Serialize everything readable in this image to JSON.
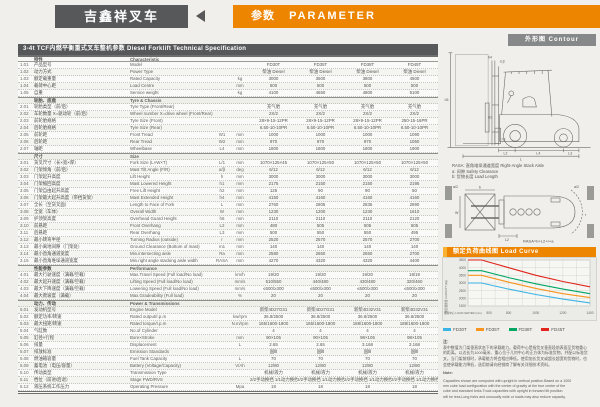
{
  "header": {
    "brand": "吉鑫祥叉车",
    "title_cn": "参数",
    "title_en": "PARAMETER"
  },
  "table": {
    "title": "3-4t TCF内燃平衡重式叉车整机参数  Diesel Forklift Technical Specification",
    "rows": [
      {
        "header": true,
        "cn": "特性",
        "en": "Characteristic"
      },
      {
        "no": "1.01",
        "cn": "产品型号",
        "en": "Model",
        "v": [
          "FD30T",
          "FD35T",
          "FD38T",
          "FD45T"
        ]
      },
      {
        "no": "1.02",
        "cn": "动力方式",
        "en": "Power Type",
        "v": [
          "柴油 Diesel",
          "柴油 Diesel",
          "柴油 Diesel",
          "柴油 Diesel"
        ]
      },
      {
        "no": "1.03",
        "cn": "额定载重量",
        "en": "Rated Capacity",
        "unit": "kg",
        "v": [
          "3000",
          "3500",
          "3800",
          "4500"
        ]
      },
      {
        "no": "1.04",
        "cn": "载荷中心距",
        "en": "Load Centre",
        "unit": "mm",
        "v": [
          "500",
          "500",
          "500",
          "500"
        ]
      },
      {
        "no": "1.05",
        "cn": "自重",
        "en": "Service weight",
        "unit": "kg",
        "v": [
          "4100",
          "4650",
          "4800",
          "5100"
        ]
      },
      {
        "section": true,
        "cn": "轮胎、底盘",
        "en": "Tyre & Chassis"
      },
      {
        "no": "2.01",
        "cn": "轮胎类型（前/后）",
        "en": "Tyre Type (Front/Rear)",
        "v": [
          "充气胎",
          "充气胎",
          "充气胎",
          "充气胎"
        ]
      },
      {
        "no": "2.02",
        "cn": "车轮数量 X=驱动轮（前/后）",
        "en": "Wheel number X=drive wheel (Front/Rear)",
        "v": [
          "2X/2",
          "2X/2",
          "2X/2",
          "2X/2"
        ]
      },
      {
        "no": "2.03",
        "cn": "前轮胎规格",
        "en": "Tyre Size (Front)",
        "v": [
          "28×9-15-12PR",
          "28×9-15-12PR",
          "28×9-15-12PR",
          "250-15-16PR"
        ]
      },
      {
        "no": "2.04",
        "cn": "后轮胎规格",
        "en": "Tyre Size (Rear)",
        "v": [
          "6.50-10-10PR",
          "6.50-10-10PR",
          "6.50-10-10PR",
          "6.50-10-10PR"
        ]
      },
      {
        "no": "2.05",
        "cn": "前轮距",
        "en": "Front Tread",
        "sym": "W1",
        "unit": "mm",
        "v": [
          "1000",
          "1000",
          "1000",
          "1090"
        ]
      },
      {
        "no": "2.06",
        "cn": "后轮距",
        "en": "Rear Tread",
        "sym": "W2",
        "unit": "mm",
        "v": [
          "970",
          "970",
          "970",
          "1060"
        ]
      },
      {
        "no": "2.07",
        "cn": "轴距",
        "en": "Wheelbase",
        "sym": "L4",
        "unit": "mm",
        "v": [
          "1800",
          "1800",
          "1800",
          "1900"
        ]
      },
      {
        "section": true,
        "cn": "尺寸",
        "en": "Size"
      },
      {
        "no": "3.01",
        "cn": "货叉尺寸（长×宽×厚）",
        "en": "Fork Size (L×W×T)",
        "sym": "L/1",
        "unit": "mm",
        "v": [
          "1070×125×45",
          "1070×125×50",
          "1070×125×50",
          "1070×125×50"
        ]
      },
      {
        "no": "3.02",
        "cn": "门架倾角（前/后）",
        "en": "Mast Tilt Angle (F/R)",
        "sym": "α/β",
        "unit": "deg",
        "v": [
          "6/12",
          "6/12",
          "6/12",
          "6/12"
        ]
      },
      {
        "no": "3.03",
        "cn": "门架起升高度",
        "en": "Lift Height",
        "sym": "h",
        "unit": "mm",
        "v": [
          "3000",
          "3000",
          "3000",
          "3000"
        ]
      },
      {
        "no": "3.04",
        "cn": "门架缩回高度",
        "en": "Mast Lowered Height",
        "sym": "h1",
        "unit": "mm",
        "v": [
          "2175",
          "2150",
          "2150",
          "2195"
        ]
      },
      {
        "no": "3.05",
        "cn": "门架自由起升高度",
        "en": "Free Lift Height",
        "sym": "h2",
        "unit": "mm",
        "v": [
          "125",
          "90",
          "90",
          "50"
        ]
      },
      {
        "no": "3.06",
        "cn": "门架最大起升高度（带挡货架）",
        "en": "Mast Extended Height",
        "sym": "h4",
        "unit": "mm",
        "v": [
          "4150",
          "4160",
          "4160",
          "4160"
        ]
      },
      {
        "no": "3.07",
        "cn": "全长（至货叉面）",
        "en": "Length to Face of Fork",
        "sym": "L",
        "unit": "mm",
        "v": [
          "2760",
          "2805",
          "2835",
          "2890"
        ]
      },
      {
        "no": "3.08",
        "cn": "全宽（车体）",
        "en": "Overall Width",
        "sym": "W",
        "unit": "mm",
        "v": [
          "1230",
          "1200",
          "1230",
          "1610"
        ]
      },
      {
        "no": "3.09",
        "cn": "护顶架高度",
        "en": "Overhead Guard Height",
        "sym": "h6",
        "unit": "mm",
        "v": [
          "2110",
          "2110",
          "2110",
          "2120"
        ]
      },
      {
        "no": "3.10",
        "cn": "前悬距",
        "en": "Front Overhang",
        "sym": "L2",
        "unit": "mm",
        "v": [
          "480",
          "505",
          "505",
          "505"
        ]
      },
      {
        "no": "3.11",
        "cn": "后悬距",
        "en": "Rear Overhang",
        "sym": "L3",
        "unit": "mm",
        "v": [
          "500",
          "550",
          "550",
          "495"
        ]
      },
      {
        "no": "3.12",
        "cn": "最小转弯半径",
        "en": "Turning Radius (outside)",
        "sym": "r",
        "unit": "mm",
        "v": [
          "2520",
          "2570",
          "2570",
          "2700"
        ]
      },
      {
        "no": "3.13",
        "cn": "最小离地间隙（门架处）",
        "en": "Ground Clearance (Bottom of mast)",
        "sym": "m1",
        "unit": "mm",
        "v": [
          "140",
          "140",
          "140",
          "140"
        ]
      },
      {
        "no": "3.14",
        "cn": "最小直角通道宽度",
        "en": "Min.intersecting aisle",
        "sym": "Ra",
        "unit": "mm",
        "v": [
          "2580",
          "2650",
          "2650",
          "2700"
        ]
      },
      {
        "no": "3.15",
        "cn": "最小直角堆垛通道宽度",
        "en": "Min.right angle stacking aisle width",
        "sym": "RASA",
        "unit": "mm",
        "v": [
          "4270",
          "4320",
          "4320",
          "4400"
        ]
      },
      {
        "section": true,
        "cn": "性能参数",
        "en": "Performance"
      },
      {
        "no": "4.01",
        "cn": "最大行驶速度（满载/空载）",
        "en": "Max.Travel Speed (Full load/No load)",
        "unit": "km/h",
        "v": [
          "19/20",
          "19/20",
          "19/20",
          "18/19"
        ]
      },
      {
        "no": "4.02",
        "cn": "最大起升速度（满载/空载）",
        "en": "Lifting Speed (Full load/No load)",
        "unit": "mm/s",
        "v": [
          "510/550",
          "440/480",
          "430/480",
          "320/460"
        ]
      },
      {
        "no": "4.03",
        "cn": "最大下降速度（满载/空载）",
        "en": "Lowering Speed (Full load/No load)",
        "unit": "mm/s",
        "v": [
          "≤600/≥300",
          "≤600/≥300",
          "≤600/≥300",
          "≤600/≥300"
        ]
      },
      {
        "no": "4.04",
        "cn": "最大爬坡度（满载）",
        "en": "Max.Gradeability (Full load)",
        "unit": "%",
        "v": [
          "20",
          "20",
          "20",
          "20"
        ]
      },
      {
        "section": true,
        "cn": "动力、传动",
        "en": "Power & Transmissions"
      },
      {
        "no": "5.01",
        "cn": "发动机型号",
        "en": "Engine Model",
        "v": [
          "新柴4D27G31",
          "新柴4D27G31",
          "新柴4D32V31",
          "新柴4D32V31"
        ]
      },
      {
        "no": "5.02",
        "cn": "额定功率/转速",
        "en": "Rated output/r.p.m",
        "unit": "kw/rpm",
        "v": [
          "36.8/2500",
          "36.8/2500",
          "36.8/2500",
          "36.8/2500"
        ]
      },
      {
        "no": "5.03",
        "cn": "最大扭矩/转速",
        "en": "Rated torque/r.p.m",
        "unit": "N.m/rpm",
        "v": [
          "165/1600-1800",
          "165/1600-1800",
          "188/1600-1800",
          "188/1600-1800"
        ]
      },
      {
        "no": "5.04",
        "cn": "气缸数",
        "en": "No.of Cylinder",
        "v": [
          "4",
          "4",
          "4",
          "4"
        ]
      },
      {
        "no": "5.05",
        "cn": "缸径×行程",
        "en": "Bore×Stroke",
        "unit": "mm",
        "v": [
          "90×105",
          "90×105",
          "98×105",
          "98×105"
        ]
      },
      {
        "no": "5.06",
        "cn": "排量",
        "en": "Displacement",
        "unit": "L",
        "v": [
          "2.65",
          "2.65",
          "3.168",
          "3.168"
        ]
      },
      {
        "no": "5.07",
        "cn": "排放标准",
        "en": "Emission Standards",
        "v": [
          "国Ⅲ",
          "国Ⅲ",
          "国Ⅲ",
          "国Ⅲ"
        ]
      },
      {
        "no": "5.08",
        "cn": "燃油箱容量",
        "en": "Fuel Tank Capacity",
        "unit": "L",
        "v": [
          "70",
          "70",
          "70",
          "70"
        ]
      },
      {
        "no": "5.09",
        "cn": "蓄电池（电压/容量）",
        "en": "Battery (Voltage/Capacity)",
        "unit": "V/Ah",
        "v": [
          "12/80",
          "12/80",
          "12/80",
          "12/80"
        ]
      },
      {
        "no": "5.10",
        "cn": "传动类型",
        "en": "Transmission Type",
        "v": [
          "机械/液力",
          "机械/液力",
          "机械/液力",
          "机械/液力"
        ]
      },
      {
        "no": "5.11",
        "cn": "档位（前进/后退）",
        "en": "Stage FWD/RVS",
        "v": [
          "2/2手动换挡 1/1动力换挡",
          "2/2手动换挡 1/1动力换挡",
          "2/2手动换挡 1/1动力换挡",
          "2/2手动换挡 1/1动力换挡"
        ]
      },
      {
        "no": "5.12",
        "cn": "液压系统工作压力",
        "en": "Operating Pressure",
        "unit": "Mpa",
        "v": [
          "18",
          "18",
          "18",
          "18"
        ]
      }
    ]
  },
  "contour": {
    "label": "外形图  Contour",
    "dims": {
      "h3": "h3",
      "h1": "h1",
      "h2": "h2",
      "h4": "h4",
      "ab": "α β",
      "L2": "L2",
      "L4": "L4",
      "L3": "L3",
      "L": "L"
    }
  },
  "topview": {
    "rasa_line": "RASA: 直角堆垛通道宽度 Right-Angle Stack Aisle",
    "a_line": "a: 间隙 Safety Clearance",
    "b_line": "b: 货物长度 Load Length",
    "formula": "RASA=b+L2+r+a",
    "dims": {
      "a2l": "a/2",
      "a2r": "a/2",
      "b": "b",
      "w": "W",
      "w1": "W1",
      "l2": "L2",
      "r": "r"
    }
  },
  "load_curve": {
    "title": "额定负荷曲线图 Load Curve"
  },
  "chart_data": {
    "type": "line",
    "title": "额定负荷曲线图 Load Curve",
    "xlabel": "载荷中心 LOAD CENTER (mm)",
    "ylabel": "额定载重量 CAPACITY (kg)",
    "x": [
      500,
      600,
      800,
      1000,
      1200,
      1400
    ],
    "xlim": [
      500,
      1400
    ],
    "ylim": [
      1500,
      4500
    ],
    "yticks": [
      4500,
      4000,
      3500,
      3000,
      2500,
      2000,
      1500
    ],
    "xticklabels": [
      500,
      800,
      1000,
      1200,
      1400
    ],
    "grid": true,
    "legend_position": "below",
    "series": [
      {
        "name": "FD30T",
        "color": "#3BB4E5",
        "values": [
          3000,
          3000,
          2600,
          2250,
          1950,
          1700
        ]
      },
      {
        "name": "FD35T",
        "color": "#F7941D",
        "values": [
          3500,
          3500,
          3050,
          2650,
          2300,
          2050
        ]
      },
      {
        "name": "FD38T",
        "color": "#00A664",
        "values": [
          3800,
          3800,
          3350,
          2950,
          2600,
          2300
        ]
      },
      {
        "name": "FD45T",
        "color": "#E1251B",
        "values": [
          4500,
          4500,
          4000,
          3500,
          3100,
          2750
        ]
      }
    ]
  },
  "notes": {
    "cn_label": "注：",
    "cn_lines": [
      "表中数值为门架垂直状态下的承载能力。载荷中心是指货叉垂直段前表面至货物重心",
      "的距离。以边长为1000毫米、重心位于几何中心的正方体为标准货物，并配以标准货",
      "叉。当门架前倾时，承载能力将会相应降低。使用加长货叉或超长超宽的货物时，也",
      "会使承载能力降低，选用前请向经销商了解有关详细技术资料。"
    ],
    "en_label": "Note:",
    "en_lines": [
      "Capacities shown are computed with upright in vertical position.Based on a 1000",
      "mm cube load configuration with the center of gravity at the true center of the",
      "cube and standard forks.Truck capacities with upright in forward tilt position",
      "will be less.Long forks and unusually wide or loads may also reduce capacity."
    ]
  },
  "colors": {
    "accent_orange": "#EE8500",
    "dark_gray": "#57585A",
    "mid_gray": "#87888A",
    "series_blue": "#3BB4E5",
    "series_orange": "#F7941D",
    "series_green": "#00A664",
    "series_red": "#E1251B"
  }
}
